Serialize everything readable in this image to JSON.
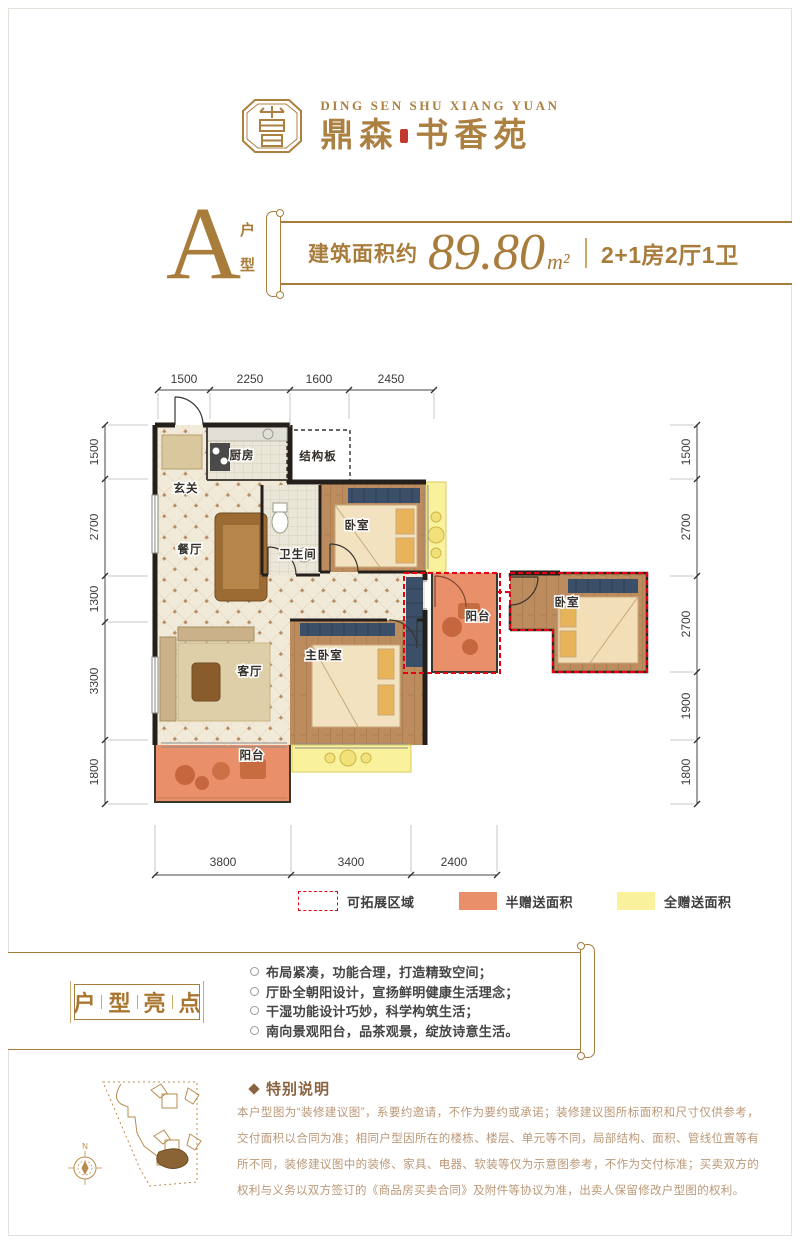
{
  "brand": {
    "name_en": "DING SEN SHU XIANG YUAN",
    "cn_left": "鼎森",
    "cn_right": "书香苑"
  },
  "unit": {
    "type_letter": "A",
    "type_chars": [
      "户",
      "型"
    ],
    "area_prefix": "建筑面积约",
    "area_value": "89.80",
    "area_unit": "m²",
    "layout_desc": "2+1房2厅1卫"
  },
  "plan": {
    "dims_top": [
      "1500",
      "2250",
      "1600",
      "2450"
    ],
    "dims_bottom": [
      "3800",
      "3400",
      "2400"
    ],
    "dims_left": [
      "1500",
      "2700",
      "1300",
      "3300",
      "1800"
    ],
    "dims_right": [
      "1500",
      "2700",
      "2700",
      "1900",
      "1800"
    ],
    "rooms": {
      "entry": "玄关",
      "kitchen": "厨房",
      "slab": "结构板",
      "dining": "餐厅",
      "bath": "卫生间",
      "bedroom": "卧室",
      "living": "客厅",
      "master": "主卧室",
      "balcony_south": "阳台",
      "balcony_east": "阳台",
      "bedroom_east": "卧室"
    }
  },
  "legend": {
    "expandable": "可拓展区域",
    "half_gift": "半赠送面积",
    "full_gift": "全赠送面积"
  },
  "highlights": {
    "title_chars": [
      "户",
      "型",
      "亮",
      "点"
    ],
    "items": [
      "布局紧凑，功能合理，打造精致空间；",
      "厅卧全朝阳设计，宣扬鲜明健康生活理念；",
      "干湿功能设计巧妙，科学构筑生活；",
      "南向景观阳台，品茶观景，绽放诗意生活。"
    ]
  },
  "notes": {
    "title": "特别说明",
    "body": "本户型图为“装修建议图”，系要约邀请，不作为要约或承诺；装修建议图所标面积和尺寸仅供参考，交付面积以合同为准；相同户型因所在的楼栋、楼层、单元等不同，局部结构、面积、管线位置等有所不同，装修建议图中的装修、家具、电器、软装等仅为示意图参考，不作为交付标准；买卖双方的权利与义务以双方签订的《商品房买卖合同》及附件等协议为准，出卖人保留修改户型图的权利。"
  },
  "sitemap": {
    "north": "N"
  },
  "colors": {
    "brand_gold": "#A87C3B",
    "legend_red": "#E60014",
    "half_gift_orange": "#E9906B",
    "full_gift_yellow": "#F9F19B",
    "wall_black": "#241F1B"
  }
}
